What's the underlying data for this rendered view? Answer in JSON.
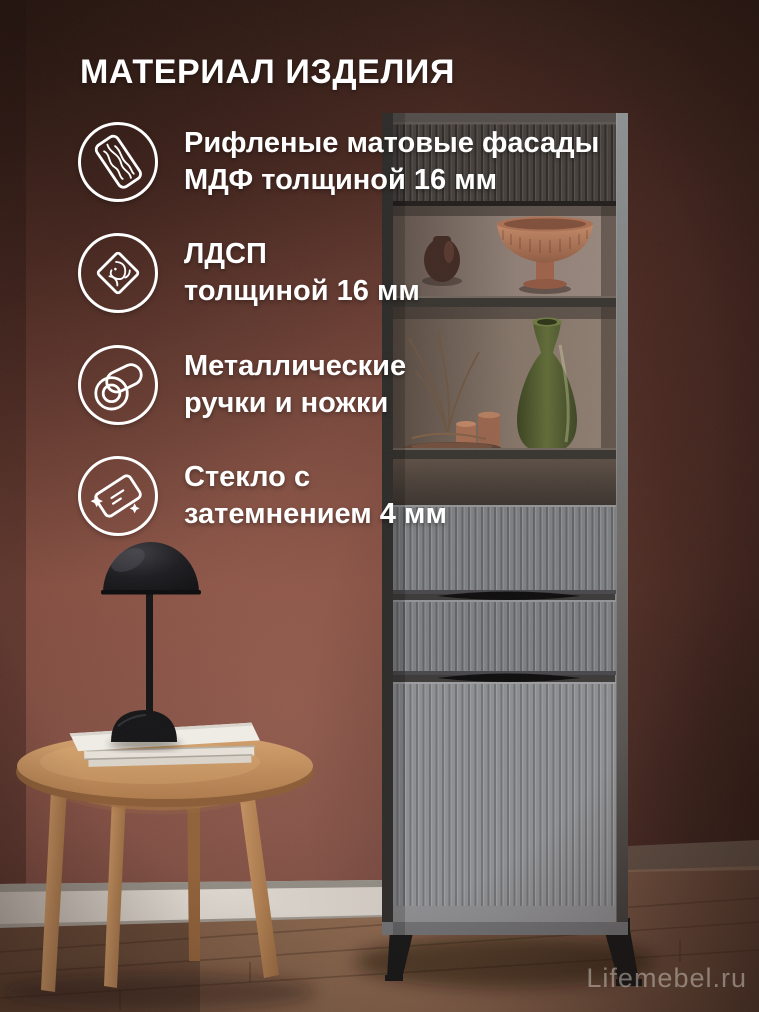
{
  "header": {
    "title": "МАТЕРИАЛ ИЗДЕЛИЯ"
  },
  "features": [
    {
      "icon": "mdf-board-icon",
      "line1": "Рифленые матовые фасады",
      "line2": "МДФ толщиной 16 мм"
    },
    {
      "icon": "chipboard-icon",
      "line1": "ЛДСП",
      "line2": "толщиной 16 мм"
    },
    {
      "icon": "metal-fittings-icon",
      "line1": "Металлические",
      "line2": "ручки и ножки"
    },
    {
      "icon": "tinted-glass-icon",
      "line1": "Стекло с",
      "line2": "затемнением 4 мм"
    }
  ],
  "watermark": "Lifemebel.ru",
  "colors": {
    "text": "#ffffff",
    "wall_burgundy": "#7a463a",
    "wall_dark": "#33201b",
    "cabinet_gray": "#87878a",
    "baseboard": "#d8d2cb",
    "floor_wood": "#7b5a43",
    "metal_black": "#141416",
    "table_wood": "#c6925f"
  },
  "scene": {
    "objects": [
      "fluted-cabinet",
      "open-shelves",
      "drawers",
      "side-table",
      "table-lamp",
      "magazine-stack",
      "terracotta-bowl",
      "small-dark-vase",
      "green-glass-vase",
      "dried-plant",
      "terracotta-candles",
      "wood-floor",
      "baseboard"
    ]
  }
}
